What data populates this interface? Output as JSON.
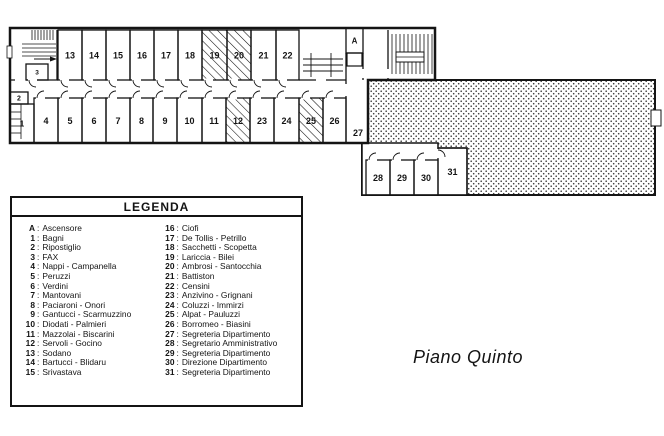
{
  "page": {
    "title": "Piano Quinto"
  },
  "legend": {
    "title": "LEGENDA",
    "columns": [
      [
        {
          "key": "A",
          "name": "Ascensore"
        },
        {
          "key": "1",
          "name": "Bagni"
        },
        {
          "key": "2",
          "name": "Ripostiglio"
        },
        {
          "key": "3",
          "name": "FAX"
        },
        {
          "key": "4",
          "name": "Nappi - Campanella"
        },
        {
          "key": "5",
          "name": "Peruzzi"
        },
        {
          "key": "6",
          "name": "Verdini"
        },
        {
          "key": "7",
          "name": "Mantovani"
        },
        {
          "key": "8",
          "name": "Paciaroni - Onori"
        },
        {
          "key": "9",
          "name": "Gantucci - Scarmuzzino"
        },
        {
          "key": "10",
          "name": "Diodati - Palmieri"
        },
        {
          "key": "11",
          "name": "Mazzolai - Biscarini"
        },
        {
          "key": "12",
          "name": "Servoli - Gocino"
        },
        {
          "key": "13",
          "name": "Sodano"
        },
        {
          "key": "14",
          "name": "Bartucci - Blidaru"
        },
        {
          "key": "15",
          "name": "Srivastava"
        }
      ],
      [
        {
          "key": "16",
          "name": "Ciofi"
        },
        {
          "key": "17",
          "name": "De Tollis - Petrillo"
        },
        {
          "key": "18",
          "name": "Sacchetti - Scopetta"
        },
        {
          "key": "19",
          "name": "Lariccia - Bilei"
        },
        {
          "key": "20",
          "name": "Ambrosi - Santocchia"
        },
        {
          "key": "21",
          "name": "Battiston"
        },
        {
          "key": "22",
          "name": "Censini"
        },
        {
          "key": "23",
          "name": "Anzivino - Grignani"
        },
        {
          "key": "24",
          "name": "Coluzzi - Immirzi"
        },
        {
          "key": "25",
          "name": "Alpat - Pauluzzi"
        },
        {
          "key": "26",
          "name": "Borromeo - Biasini"
        },
        {
          "key": "27",
          "name": "Segreteria Dipartimento"
        },
        {
          "key": "28",
          "name": "Segretario Amministrativo"
        },
        {
          "key": "29",
          "name": "Segreteria Dipartimento"
        },
        {
          "key": "30",
          "name": "Direzione Dipartimento"
        },
        {
          "key": "31",
          "name": "Segreteria Dipartimento"
        }
      ]
    ]
  },
  "plan": {
    "colors": {
      "line": "#141414",
      "paper": "#ffffff"
    },
    "rooms": [
      {
        "label": "13",
        "x": 58,
        "y": 30,
        "w": 24,
        "h": 50,
        "door": "bottom"
      },
      {
        "label": "14",
        "x": 82,
        "y": 30,
        "w": 24,
        "h": 50,
        "door": "bottom"
      },
      {
        "label": "15",
        "x": 106,
        "y": 30,
        "w": 24,
        "h": 50,
        "door": "bottom"
      },
      {
        "label": "16",
        "x": 130,
        "y": 30,
        "w": 24,
        "h": 50,
        "door": "bottom"
      },
      {
        "label": "17",
        "x": 154,
        "y": 30,
        "w": 24,
        "h": 50,
        "door": "bottom"
      },
      {
        "label": "18",
        "x": 178,
        "y": 30,
        "w": 24,
        "h": 50,
        "door": "bottom"
      },
      {
        "label": "19",
        "x": 202,
        "y": 30,
        "w": 25,
        "h": 50,
        "door": "bottom",
        "hatched": true
      },
      {
        "label": "20",
        "x": 227,
        "y": 30,
        "w": 24,
        "h": 50,
        "door": "bottom",
        "hatched": true
      },
      {
        "label": "21",
        "x": 251,
        "y": 30,
        "w": 25,
        "h": 50,
        "door": "bottom"
      },
      {
        "label": "22",
        "x": 276,
        "y": 30,
        "w": 23,
        "h": 50,
        "door": "bottom"
      },
      {
        "label": "1",
        "x": 10,
        "y": 104,
        "w": 24,
        "h": 39,
        "door": "none",
        "fs": 8
      },
      {
        "label": "2",
        "x": 10,
        "y": 92,
        "w": 18,
        "h": 12,
        "door": "none",
        "fs": 7
      },
      {
        "label": "3",
        "x": 26,
        "y": 64,
        "w": 22,
        "h": 16,
        "door": "bottom",
        "fs": 6.5
      },
      {
        "label": "4",
        "x": 34,
        "y": 98,
        "w": 24,
        "h": 45,
        "door": "top"
      },
      {
        "label": "5",
        "x": 58,
        "y": 98,
        "w": 24,
        "h": 45,
        "door": "top"
      },
      {
        "label": "6",
        "x": 82,
        "y": 98,
        "w": 24,
        "h": 45,
        "door": "top"
      },
      {
        "label": "7",
        "x": 106,
        "y": 98,
        "w": 24,
        "h": 45,
        "door": "top"
      },
      {
        "label": "8",
        "x": 130,
        "y": 98,
        "w": 23,
        "h": 45,
        "door": "top"
      },
      {
        "label": "9",
        "x": 153,
        "y": 98,
        "w": 24,
        "h": 45,
        "door": "top"
      },
      {
        "label": "10",
        "x": 177,
        "y": 98,
        "w": 25,
        "h": 45,
        "door": "top"
      },
      {
        "label": "11",
        "x": 202,
        "y": 98,
        "w": 24,
        "h": 45,
        "door": "top"
      },
      {
        "label": "12",
        "x": 226,
        "y": 98,
        "w": 24,
        "h": 45,
        "door": "top",
        "hatched": true
      },
      {
        "label": "23",
        "x": 250,
        "y": 98,
        "w": 24,
        "h": 45,
        "door": "top"
      },
      {
        "label": "24",
        "x": 274,
        "y": 98,
        "w": 25,
        "h": 45,
        "door": "top"
      },
      {
        "label": "25",
        "x": 299,
        "y": 98,
        "w": 24,
        "h": 45,
        "door": "top",
        "hatched": true
      },
      {
        "label": "26",
        "x": 323,
        "y": 98,
        "w": 23,
        "h": 45,
        "door": "top"
      },
      {
        "label": "A",
        "x": 346,
        "y": 28,
        "w": 17,
        "h": 25,
        "door": "none",
        "fs": 8
      },
      {
        "label": "28",
        "x": 366,
        "y": 160,
        "w": 24,
        "h": 35,
        "door": "top"
      },
      {
        "label": "29",
        "x": 390,
        "y": 160,
        "w": 24,
        "h": 35,
        "door": "top"
      },
      {
        "label": "30",
        "x": 414,
        "y": 160,
        "w": 24,
        "h": 35,
        "door": "top"
      },
      {
        "label": "31",
        "x": 438,
        "y": 148,
        "w": 29,
        "h": 47,
        "door": "left"
      }
    ],
    "labels": [
      {
        "text": "27",
        "x": 358,
        "y": 136,
        "fs": 9
      }
    ],
    "stair_hatches": [
      {
        "x1": 392,
        "y1": 34,
        "x2": 392,
        "y2": 74,
        "count": 11,
        "dx": 4,
        "dy": 0
      },
      {
        "x1": 32,
        "y1": 30,
        "x2": 32,
        "y2": 40,
        "count": 8,
        "dx": 3,
        "dy": 0
      },
      {
        "x1": 22,
        "y1": 44,
        "x2": 56,
        "y2": 44,
        "count": 4,
        "dx": 0,
        "dy": 4
      }
    ],
    "hall_lines": {
      "ys": [
        59,
        65,
        71
      ],
      "x1": 303,
      "x2": 343,
      "ticks": [
        311,
        331
      ],
      "ty1": 53,
      "ty2": 77
    },
    "fixture_lines": {
      "ys": [
        112,
        119,
        126,
        133
      ],
      "x1": 10,
      "x2": 21,
      "v": {
        "x": 21,
        "y1": 104,
        "y2": 139
      }
    }
  }
}
